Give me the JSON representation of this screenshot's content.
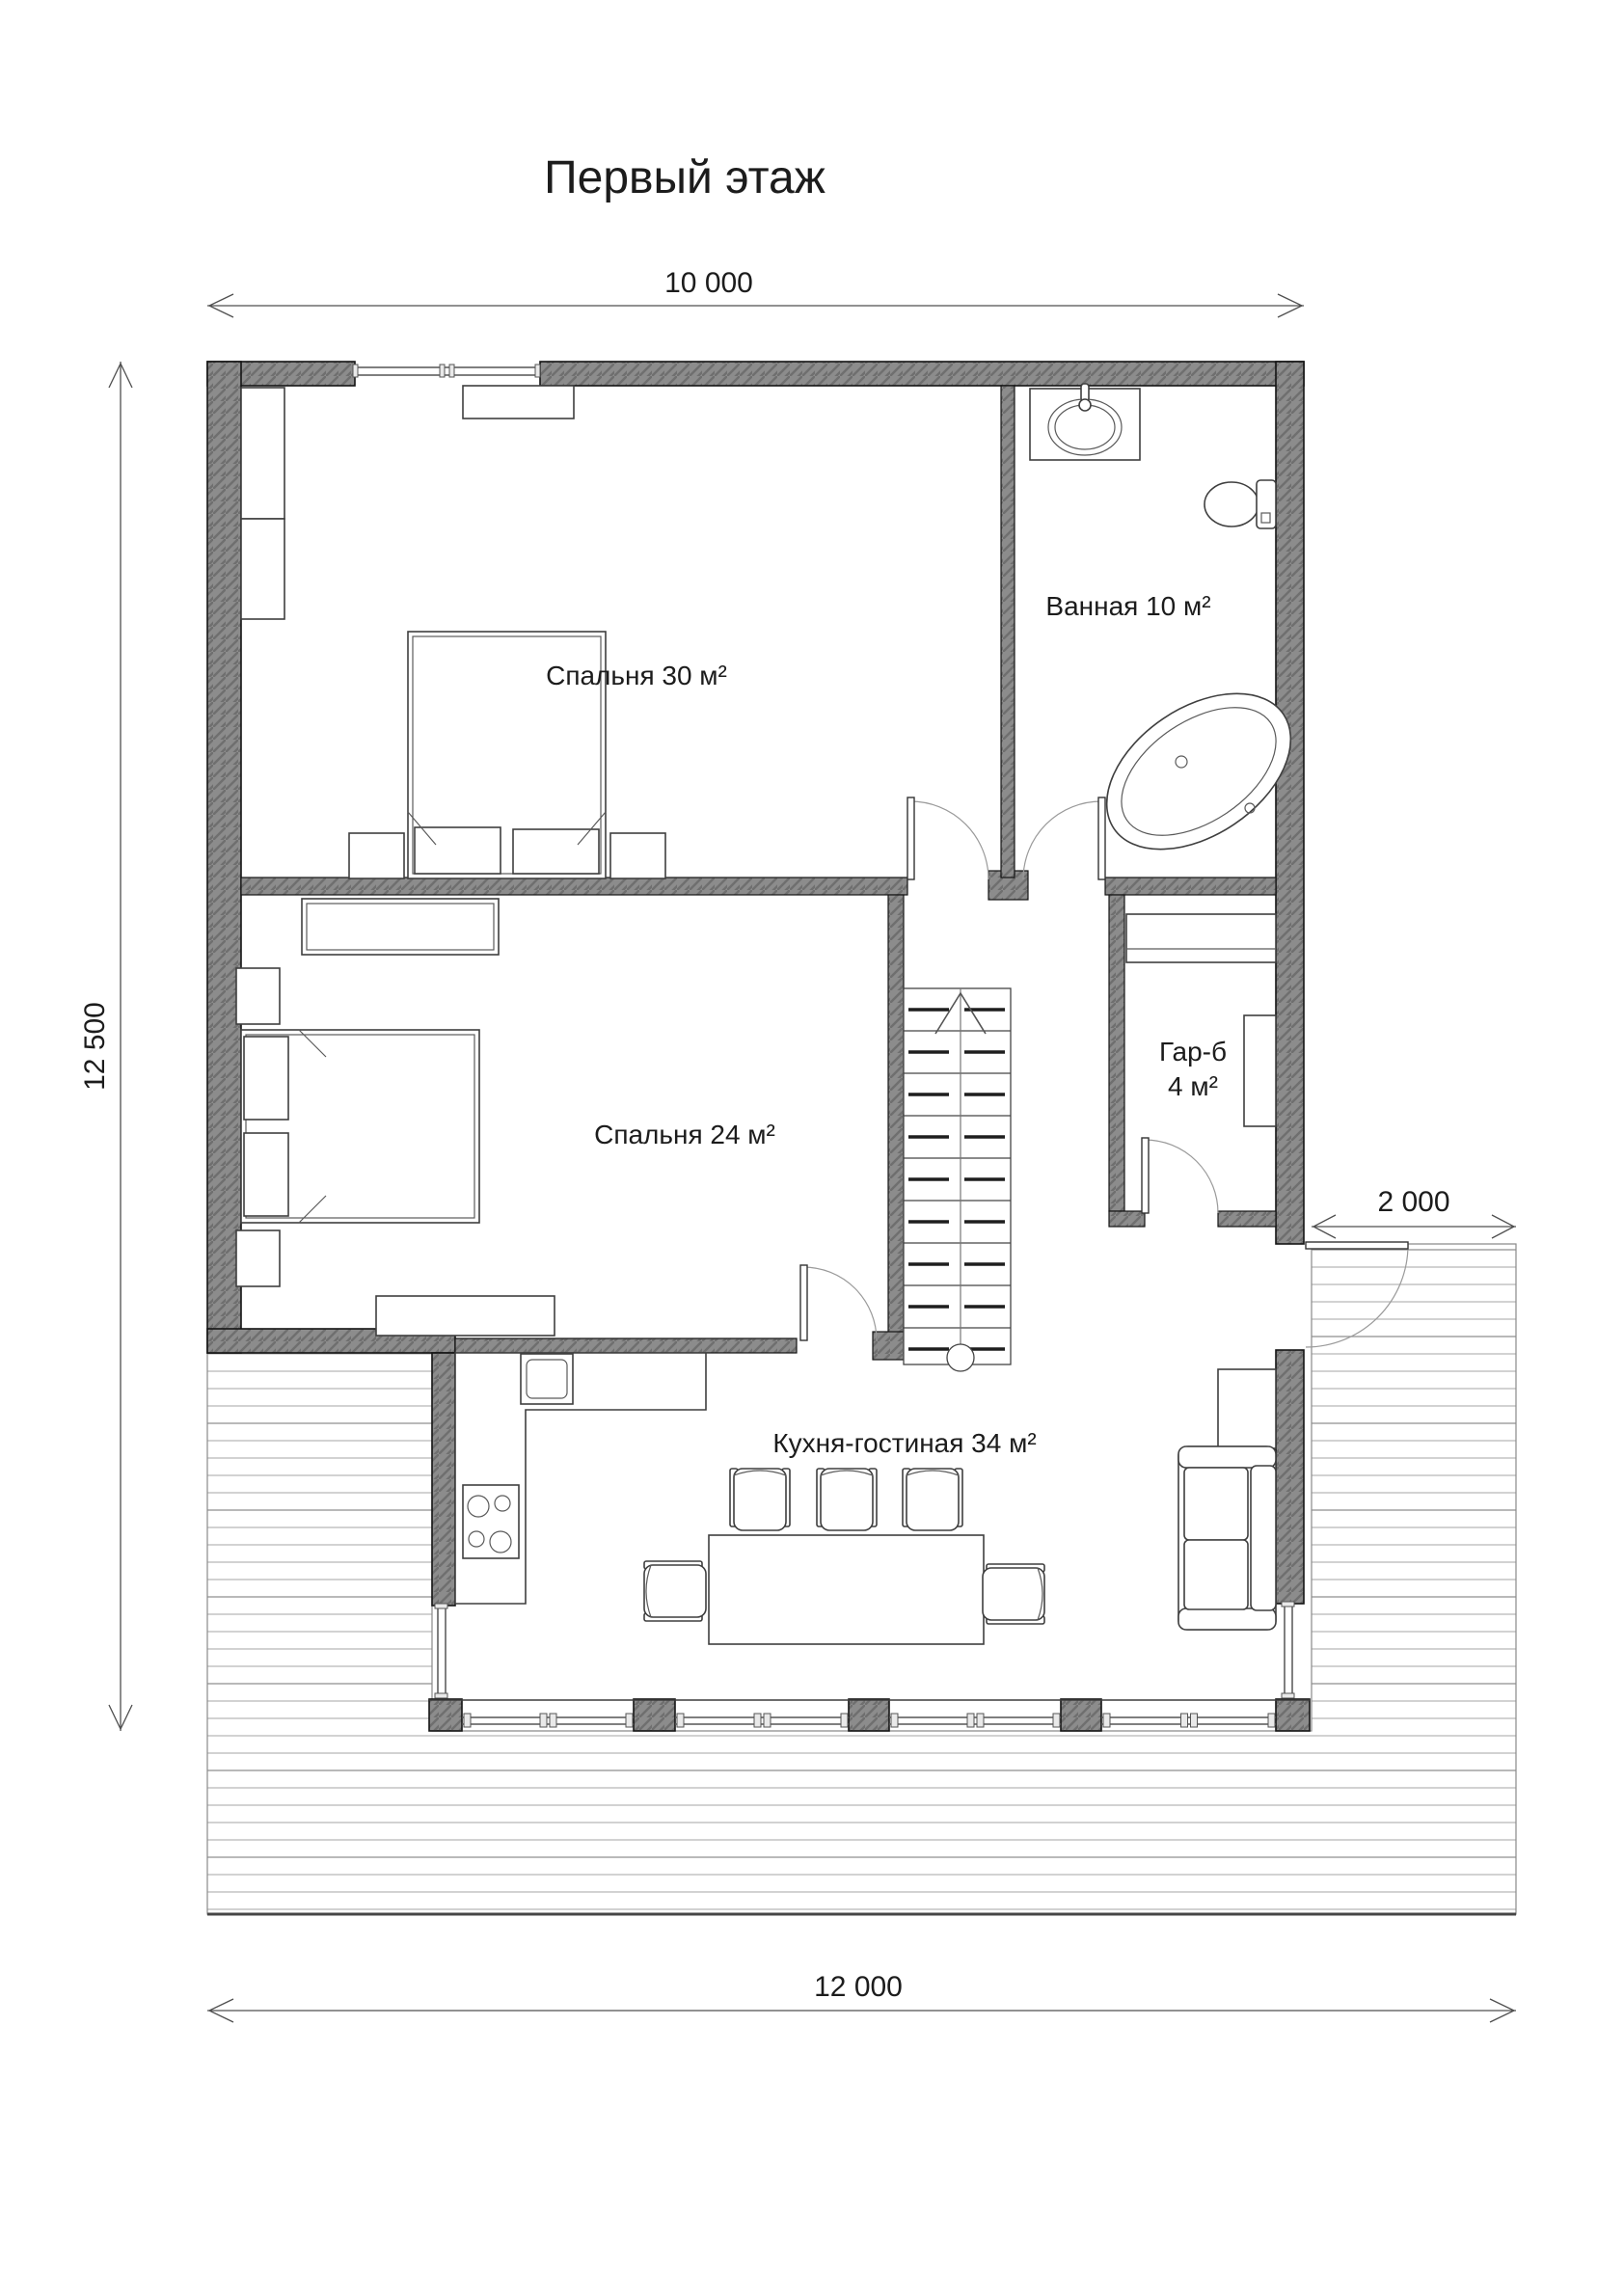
{
  "title": "Первый этаж",
  "dimensions": {
    "top": "10 000",
    "left": "12 500",
    "right": "2 000",
    "bottom": "12 000"
  },
  "rooms": {
    "bedroom30": {
      "label": "Спальня 30 м²"
    },
    "bathroom": {
      "label": "Ванная 10 м²"
    },
    "bedroom24": {
      "label": "Спальня 24 м²"
    },
    "wardrobe": {
      "label": "Гар-б",
      "area": "4 м²"
    },
    "kitchen": {
      "label": "Кухня-гостиная 34 м²"
    }
  },
  "icons": [
    "bed-icon",
    "nightstand-icon",
    "closet-icon",
    "dresser-icon",
    "sink-icon",
    "toilet-icon",
    "bathtub-icon",
    "stairs-up-arrow-icon",
    "stove-icon",
    "kitchen-sink-icon",
    "dining-table",
    "chair-icon",
    "sofa-icon",
    "side-table-icon",
    "door-swing-icon",
    "window-icon",
    "deck-planks"
  ],
  "colors": {
    "wall_fill": "#8c8c8c",
    "wall_hatch": "#6f6f6f",
    "wall_outline": "#141414",
    "deck_line": "#b4b4b4",
    "dimension_line": "#4f4f4f",
    "text": "#1c1c1c",
    "background": "#ffffff"
  }
}
